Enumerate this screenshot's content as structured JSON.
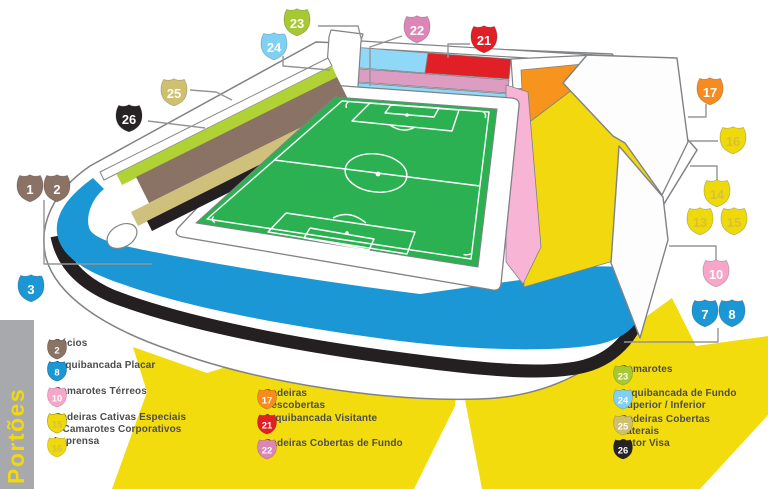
{
  "portoes": {
    "label": "Portões"
  },
  "colors": {
    "brown": "#8a7265",
    "blue": "#1b97d5",
    "pink": "#f7a6c9",
    "yellow": "#eed90b",
    "yellow_number": "#d9c232",
    "tan": "#cfc06f",
    "orange": "#f68b1f",
    "red": "#e01f26",
    "magenta": "#dd85b7",
    "lime": "#a6c832",
    "lightblue": "#7fd0f2",
    "black": "#272325",
    "ring_blue": "#1b97d5",
    "field_green": "#2cb152",
    "starburst_yellow": "#f3dc0d",
    "bar_gray": "#a7a9ac"
  },
  "legend": {
    "columns": [
      {
        "items": [
          {
            "numbers": [
              "1",
              "2"
            ],
            "color": "brown",
            "label": "Sócios"
          },
          {
            "numbers": [
              "3",
              "7",
              "8"
            ],
            "asterisk_number": "3",
            "color": "blue",
            "label": "Arquibancada Placar"
          },
          {
            "numbers": [
              "10"
            ],
            "color": "pink",
            "label": "Camarotes Térreos"
          },
          {
            "numbers": [
              "13",
              "14",
              "15"
            ],
            "color": "yellow",
            "label": "Cadeiras Cativas Especiais\ne Camarotes Corporativos"
          },
          {
            "numbers": [
              "16"
            ],
            "color": "yellow",
            "label": "Imprensa"
          }
        ]
      },
      {
        "items": [
          {
            "numbers": [
              "17"
            ],
            "color": "orange",
            "label": "Cadeiras\nDescobertas"
          },
          {
            "numbers": [
              "21"
            ],
            "color": "red",
            "label": "Arquibancada Visitante"
          },
          {
            "numbers": [
              "22"
            ],
            "color": "magenta",
            "label": "Cadeiras Cobertas de Fundo"
          }
        ]
      },
      {
        "items": [
          {
            "numbers": [
              "23"
            ],
            "color": "lime",
            "label": "Camarotes"
          },
          {
            "numbers": [
              "24"
            ],
            "color": "lightblue",
            "label": "Arquibancada de Fundo\nSuperior / Inferior"
          },
          {
            "numbers": [
              "25"
            ],
            "color": "tan",
            "label": "Cadeiras Cobertas\nLaterais"
          },
          {
            "numbers": [
              "26"
            ],
            "color": "black",
            "label": "Setor Visa"
          }
        ]
      }
    ]
  },
  "diagram": {
    "gates": [
      {
        "number": "1",
        "color": "brown"
      },
      {
        "number": "2",
        "color": "brown"
      },
      {
        "number": "3",
        "color": "blue",
        "asterisk": true
      },
      {
        "number": "7",
        "color": "blue"
      },
      {
        "number": "8",
        "color": "blue"
      },
      {
        "number": "10",
        "color": "pink"
      },
      {
        "number": "13",
        "color": "yellow"
      },
      {
        "number": "14",
        "color": "yellow"
      },
      {
        "number": "15",
        "color": "yellow"
      },
      {
        "number": "16",
        "color": "yellow"
      },
      {
        "number": "17",
        "color": "orange"
      },
      {
        "number": "21",
        "color": "red"
      },
      {
        "number": "22",
        "color": "magenta"
      },
      {
        "number": "23",
        "color": "lime"
      },
      {
        "number": "24",
        "color": "lightblue",
        "asterisk": true
      },
      {
        "number": "25",
        "color": "tan"
      },
      {
        "number": "26",
        "color": "black"
      }
    ]
  }
}
